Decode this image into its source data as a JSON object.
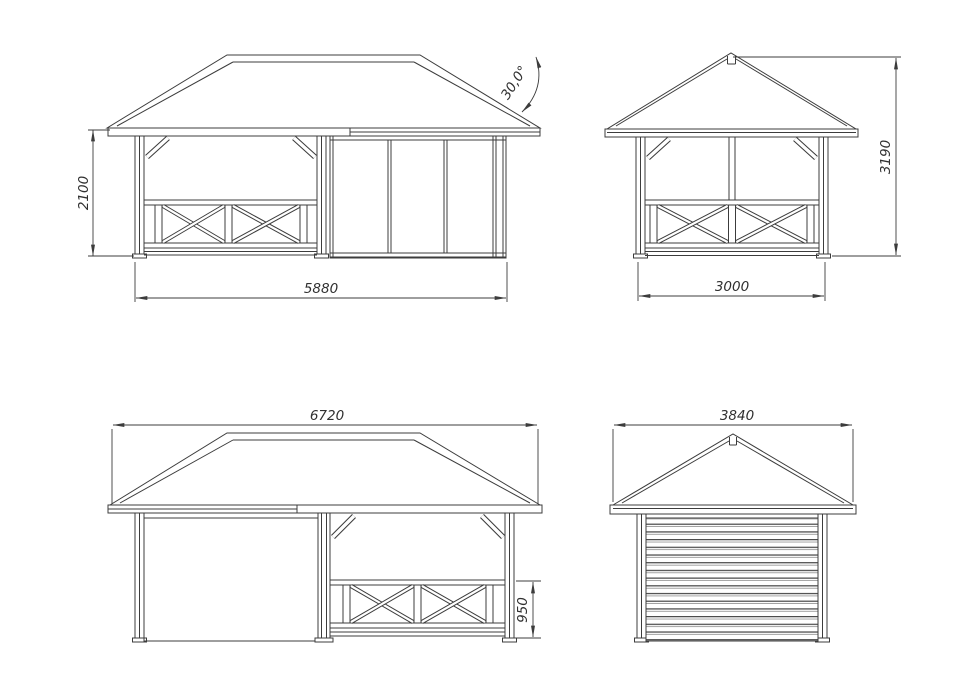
{
  "drawing": {
    "background": "#ffffff",
    "line_color": "#3c3c3c",
    "views": {
      "front": {
        "width": "5880",
        "height": "2100",
        "roof_angle": "30,0°"
      },
      "side_a": {
        "width": "3000",
        "height": "3190"
      },
      "rear": {
        "roof_width": "6720",
        "railing_height": "950"
      },
      "side_b": {
        "roof_width": "3840"
      }
    }
  }
}
